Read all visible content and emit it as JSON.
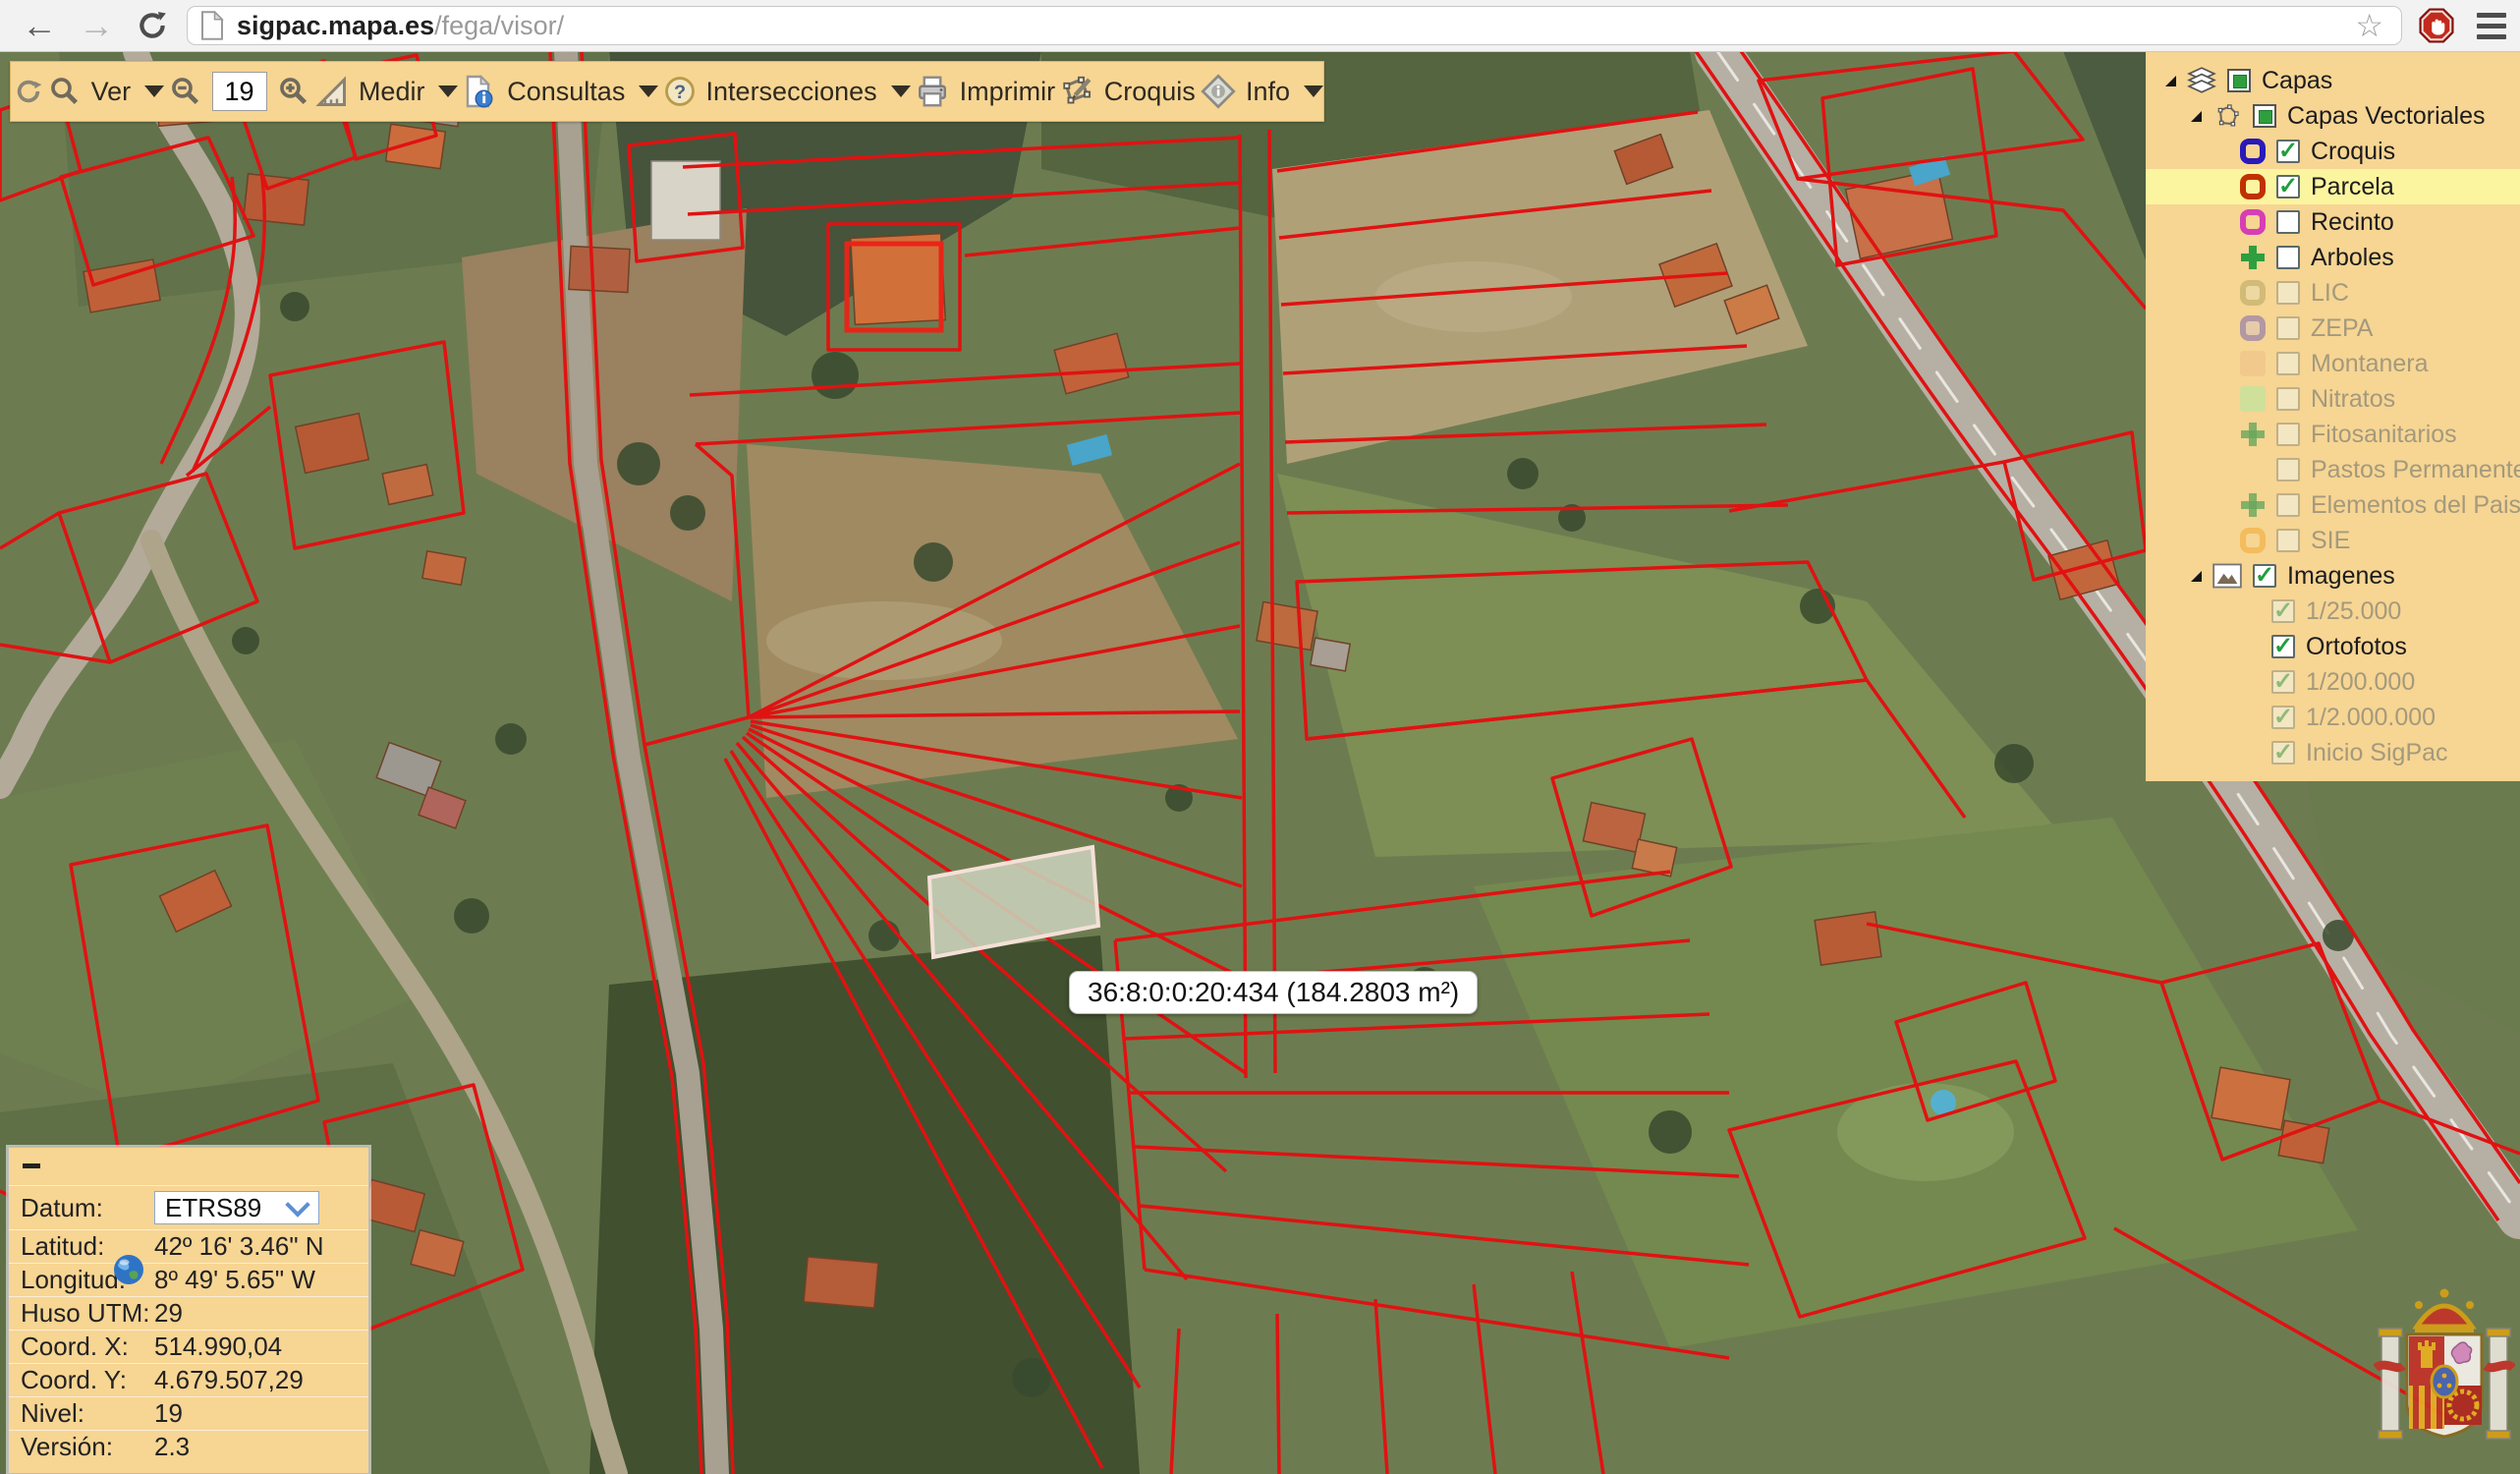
{
  "browser": {
    "url_domain": "sigpac.mapa.es",
    "url_path": "/fega/visor/"
  },
  "toolbar": {
    "ver_label": "Ver",
    "zoom_value": "19",
    "medir_label": "Medir",
    "consultas_label": "Consultas",
    "intersecciones_label": "Intersecciones",
    "imprimir_label": "Imprimir",
    "croquis_label": "Croquis",
    "info_label": "Info"
  },
  "layers_panel": {
    "root_label": "Capas",
    "vector_group_label": "Capas Vectoriales",
    "images_group_label": "Imagenes",
    "vector_layers": [
      {
        "label": "Croquis",
        "checked": true,
        "enabled": true,
        "color": "#2a1ab8"
      },
      {
        "label": "Parcela",
        "checked": true,
        "enabled": true,
        "color": "#bf3100",
        "highlight": true
      },
      {
        "label": "Recinto",
        "checked": false,
        "enabled": true,
        "color": "#d63fb4"
      },
      {
        "label": "Arboles",
        "checked": false,
        "enabled": true,
        "color": "#2f9e3f"
      },
      {
        "label": "LIC",
        "checked": false,
        "enabled": false,
        "color": "#b3a75f",
        "tint": "#e6dcae"
      },
      {
        "label": "ZEPA",
        "checked": false,
        "enabled": false,
        "color": "#7a67b0",
        "tint": "#d8c3c0"
      },
      {
        "label": "Montanera",
        "checked": false,
        "enabled": false,
        "color": "#f2c98c"
      },
      {
        "label": "Nitratos",
        "checked": false,
        "enabled": false,
        "color": "#cfe09a"
      },
      {
        "label": "Fitosanitarios",
        "checked": false,
        "enabled": false,
        "color": "#66a85c"
      },
      {
        "label": "Pastos Permanentes",
        "checked": false,
        "enabled": false
      },
      {
        "label": "Elementos del Paisaje",
        "checked": false,
        "enabled": false,
        "color": "#66a85c"
      },
      {
        "label": "SIE",
        "checked": false,
        "enabled": false,
        "color": "#f0a832"
      }
    ],
    "image_layers": [
      {
        "label": "1/25.000",
        "checked": true,
        "enabled": false
      },
      {
        "label": "Ortofotos",
        "checked": true,
        "enabled": true
      },
      {
        "label": "1/200.000",
        "checked": true,
        "enabled": false
      },
      {
        "label": "1/2.000.000",
        "checked": true,
        "enabled": false
      },
      {
        "label": "Inicio SigPac",
        "checked": true,
        "enabled": false
      }
    ]
  },
  "coords_panel": {
    "rows": [
      {
        "label": "Datum:",
        "value": "ETRS89"
      },
      {
        "label": "Latitud:",
        "value": "42º 16' 3.46\" N"
      },
      {
        "label": "Longitud:",
        "value": "8º 49' 5.65\" W"
      },
      {
        "label": "Huso UTM:",
        "value": "29"
      },
      {
        "label": "Coord. X:",
        "value": "514.990,04"
      },
      {
        "label": "Coord. Y:",
        "value": "4.679.507,29"
      },
      {
        "label": "Nivel:",
        "value": "19"
      },
      {
        "label": "Versión:",
        "value": "2.3"
      }
    ]
  },
  "map": {
    "tooltip": "36:8:0:0:20:434 (184.2803 m²)"
  },
  "colors": {
    "panel_bg": "#f7d593",
    "row_highlight": "#fcf59f",
    "parcel_line": "#e01212",
    "selected_parcel_fill": "#c9d2ba",
    "selected_parcel_stroke": "#f5e0d8",
    "disabled_text": "#a39a7d",
    "enabled_text": "#1c1c1c"
  }
}
